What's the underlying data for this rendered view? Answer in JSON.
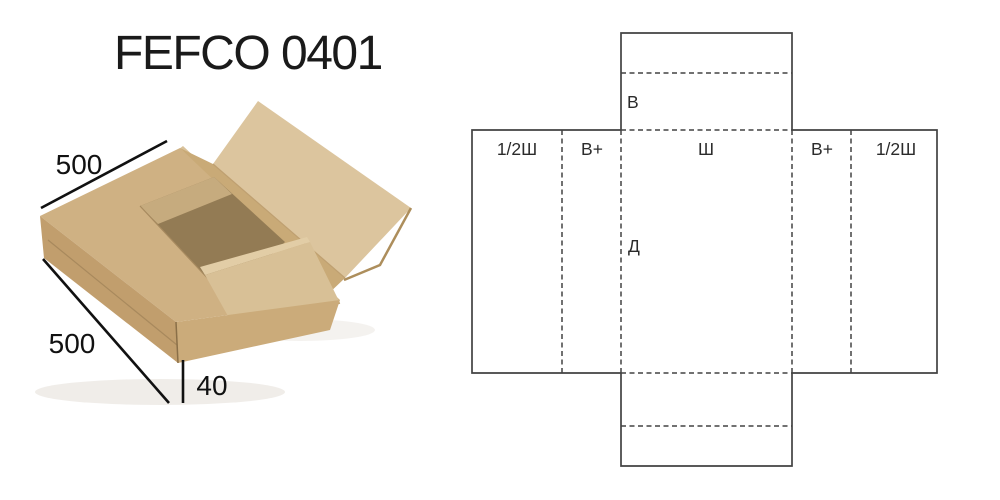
{
  "title": "FEFCO 0401",
  "photo": {
    "description": "kraft cardboard wrap-around box, partially open",
    "dim_top": "500",
    "dim_side": "500",
    "dim_height": "40"
  },
  "diagram": {
    "columns": [
      "1/2Ш",
      "В+",
      "Ш",
      "В+",
      "1/2Ш"
    ],
    "flap_height_label": "В",
    "length_label": "Д"
  },
  "colors": {
    "dieline_stroke": "#424242",
    "dimension_stroke": "#111111",
    "kraft_light": "#dcc59e",
    "kraft_mid": "#cfb183",
    "kraft_dark": "#c19e6d",
    "kraft_inner_shadow": "#937b54",
    "background": "#ffffff"
  }
}
